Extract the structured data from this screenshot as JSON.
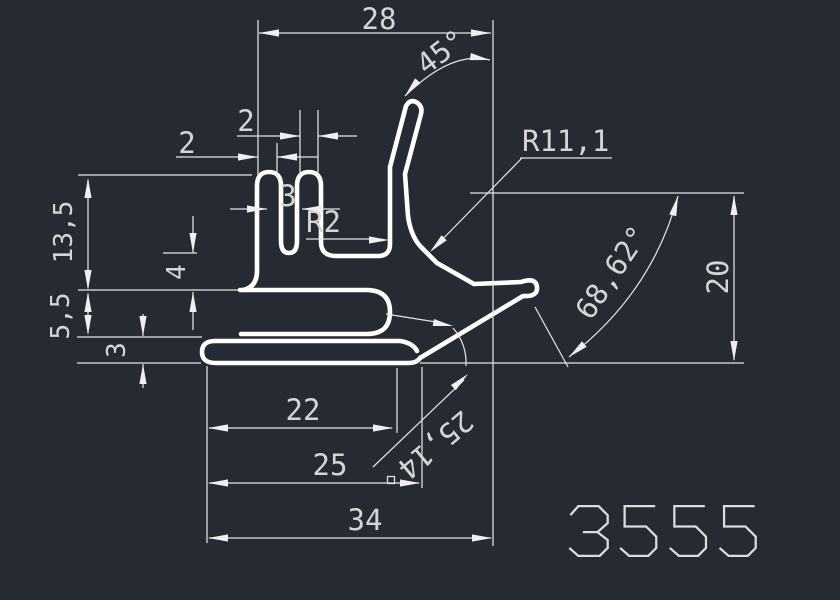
{
  "drawing": {
    "number": "3555",
    "background": "#262b33",
    "line_color": "#ffffff",
    "dim_color": "#e3e3e3"
  },
  "dims": {
    "top_width": "28",
    "tip_angle": "45°",
    "big_radius": "R11,1",
    "slot_a": "2",
    "slot_b": "2",
    "prong_width": "3",
    "fillet_radius": "R2",
    "left_h1": "13,5",
    "left_h2": "4",
    "left_h3": "5,5",
    "left_h4": "3",
    "right_height": "20",
    "leg_angle": "68,62°",
    "bottom_a": "22",
    "bottom_b": "25",
    "bottom_c": "34",
    "lip_length": "25,14"
  }
}
